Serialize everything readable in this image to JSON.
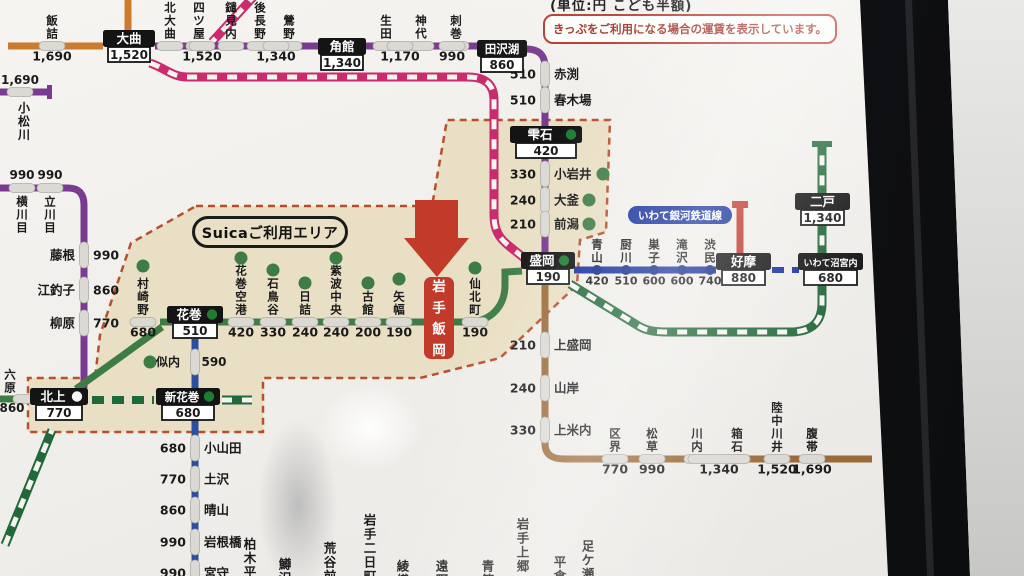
{
  "photo": {
    "caption": "(単位:円 こども半額)",
    "notice": "きっぷをご利用になる場合の運賃を表示しています。"
  },
  "labels": {
    "suica_area": "Suicaご利用エリア",
    "igr": "いわて銀河鉄道線"
  },
  "colors": {
    "orange": "#cc7a2e",
    "purple": "#7a3a92",
    "pink": "#c92b6d",
    "green": "#3e7c46",
    "shin": "#21683a",
    "kama": "#2b4fa0",
    "igr": "#16309e",
    "yamada": "#9c6a38",
    "hanawa": "#c0392b",
    "stripe": "#f6f4f0",
    "dot": "#3e7c46",
    "igrdot": "#122a8a",
    "pill": "#dbd9d4",
    "pillStroke": "#aeaca7",
    "beige": "#e9dfc4",
    "beigeBorder": "#b5502c",
    "boxBlack": "#141414",
    "arrowRed": "#c23a2a",
    "circleGreen": "#1e7d32",
    "circleWhite": "#f5f5f5",
    "text": "#1a1a1a"
  },
  "map": {
    "suica_polygon": "196,206 432,206 447,120 610,120 606,232 580,240 577,285 500,358 420,378 263,378 263,432 28,432 28,378 95,378 100,335 131,243",
    "elements": [
      {
        "t": "ln",
        "n": "line-ou-main",
        "d": "M 8,46 L 103,46",
        "c": "orange",
        "w": 7,
        "st": "solid"
      },
      {
        "t": "ln",
        "n": "line-ou-north",
        "d": "M 128,0 L 128,31",
        "c": "orange",
        "w": 7,
        "st": "solid"
      },
      {
        "t": "ln",
        "n": "line-kitakami-west",
        "d": "M 0,92 L 50,92",
        "c": "purple",
        "w": 7,
        "st": "solid"
      },
      {
        "t": "rc",
        "n": "line-kitakami-west-endcap",
        "x": 47,
        "y": 85,
        "w": 5,
        "h": 14,
        "c": "purple"
      },
      {
        "t": "ln",
        "n": "line-kitakami",
        "d": "M 0,188 L 68,188 C 79,188 84,194 84,205 L 84,388",
        "c": "purple",
        "w": 7,
        "st": "solid"
      },
      {
        "t": "ln",
        "n": "line-akita-shinkansen-nw",
        "d": "M 256,-6 L 212,42",
        "c": "pink",
        "w": 9,
        "st": "striped"
      },
      {
        "t": "ln",
        "n": "line-akita-shinkansen",
        "d": "M 150,63 C 167,69 172,77 188,77 L 468,77 C 486,77 494,85 494,100 L 494,215 C 494,230 499,238 509,246 L 524,258",
        "c": "pink",
        "w": 9,
        "st": "striped"
      },
      {
        "t": "ln",
        "n": "line-tazawako-top",
        "d": "M 155,46 L 478,46",
        "c": "purple",
        "w": 7,
        "st": "solid"
      },
      {
        "t": "ln",
        "n": "line-tazawako-bend",
        "d": "M 526,49 C 540,49 545,56 545,67 L 545,126",
        "c": "purple",
        "w": 7,
        "st": "solid"
      },
      {
        "t": "ln",
        "n": "line-tazawako-south",
        "d": "M 545,158 L 545,254",
        "c": "purple",
        "w": 7,
        "st": "solid"
      },
      {
        "t": "ln",
        "n": "line-tohoku-main-west",
        "d": "M 0,399 L 31,399",
        "c": "green",
        "w": 7,
        "st": "solid"
      },
      {
        "t": "ln",
        "n": "line-tohoku-main-diag",
        "d": "M 76,389 L 162,327",
        "c": "green",
        "w": 7,
        "st": "solid"
      },
      {
        "t": "ln",
        "n": "line-tohoku-main",
        "d": "M 160,322 L 474,322",
        "c": "green",
        "w": 7,
        "st": "solid"
      },
      {
        "t": "ln",
        "n": "line-tohoku-main-morioka",
        "d": "M 455,322 L 468,322 C 492,322 505,305 505,285 L 505,272 L 522,271",
        "c": "green",
        "w": 7,
        "st": "solid"
      },
      {
        "t": "ln",
        "n": "line-kamaishi",
        "d": "M 195,339 L 195,576",
        "c": "kama",
        "w": 7,
        "st": "solid"
      },
      {
        "t": "ln",
        "n": "line-tohoku-shinkansen-sw",
        "d": "M 5,545 L 52,430",
        "c": "shin",
        "w": 9,
        "st": "striped"
      },
      {
        "t": "ln",
        "n": "line-tohoku-shinkansen-dash",
        "d": "M 92,400 L 154,400",
        "c": "shin",
        "w": 8,
        "st": "dashed"
      },
      {
        "t": "ln",
        "n": "line-tohoku-shinkansen-stub",
        "d": "M 222,400 L 252,400",
        "c": "shin",
        "w": 9,
        "st": "striped"
      },
      {
        "t": "ln",
        "n": "line-tohoku-shinkansen-north",
        "d": "M 570,284 L 637,325 C 646,331 655,332 668,332 L 790,332 C 812,332 822,322 822,303 L 822,146",
        "c": "shin",
        "w": 9,
        "st": "striped"
      },
      {
        "t": "rc",
        "n": "line-shinkansen-endcap",
        "x": 812,
        "y": 141,
        "w": 20,
        "h": 6,
        "c": "shin"
      },
      {
        "t": "ln",
        "n": "line-igr",
        "d": "M 574,270 L 716,270",
        "c": "igr",
        "w": 7,
        "st": "solid"
      },
      {
        "t": "ln",
        "n": "line-igr-dash",
        "d": "M 772,270 L 799,270",
        "c": "igr",
        "w": 6,
        "st": "dashed"
      },
      {
        "t": "ln",
        "n": "line-hanawa",
        "d": "M 740,208 L 740,253",
        "c": "hanawa",
        "w": 7,
        "st": "solid"
      },
      {
        "t": "rc",
        "n": "line-hanawa-endcap",
        "x": 732,
        "y": 201,
        "w": 16,
        "h": 7,
        "c": "hanawa"
      },
      {
        "t": "ln",
        "n": "line-yamada",
        "d": "M 545,285 L 545,443 C 545,455 552,459 565,459 L 872,459",
        "c": "yamada",
        "w": 7,
        "st": "solid"
      },
      {
        "t": "col",
        "n": "station-iizume",
        "x": 52,
        "nm": "飯詰",
        "ly": 46,
        "fare": "1,690"
      },
      {
        "t": "col",
        "n": "station-kitaomagari",
        "x": 170,
        "nm": "北大曲",
        "ly": 46
      },
      {
        "t": "col",
        "n": "station-ugoyotsuya",
        "x": 199,
        "nm": "羽後四ツ屋",
        "ly": 46
      },
      {
        "t": "col",
        "n": "station-yariminai",
        "x": 231,
        "nm": "鑓見内",
        "ly": 46
      },
      {
        "t": "col",
        "n": "station-ugonagano",
        "x": 260,
        "nm": "羽後長野",
        "ly": 46
      },
      {
        "t": "col",
        "n": "station-uguisuno",
        "x": 289,
        "nm": "鶯野",
        "ly": 46
      },
      {
        "t": "col",
        "n": "station-shoden",
        "x": 386,
        "nm": "生田",
        "ly": 46
      },
      {
        "t": "col",
        "n": "station-jindai",
        "x": 421,
        "nm": "神代",
        "ly": 46
      },
      {
        "t": "col",
        "n": "station-sashimaki",
        "x": 456,
        "nm": "刺巻",
        "ly": 46
      },
      {
        "t": "fp",
        "n": "fare-1520",
        "x": 202,
        "y": 46,
        "tx": "1,520"
      },
      {
        "t": "fp",
        "n": "fare-1340",
        "x": 276,
        "y": 46,
        "tx": "1,340"
      },
      {
        "t": "fp",
        "n": "fare-1170",
        "x": 400,
        "y": 46,
        "tx": "1,170"
      },
      {
        "t": "fp",
        "n": "fare-990",
        "x": 452,
        "y": 46,
        "tx": "990"
      },
      {
        "t": "fa",
        "n": "station-yokokawame",
        "x": 22,
        "ly": 188,
        "fare": "990",
        "nm": "横川目"
      },
      {
        "t": "fa",
        "n": "station-tatekawame",
        "x": 50,
        "ly": 188,
        "fare": "990",
        "nm": "立川目"
      },
      {
        "t": "rw",
        "n": "station-fujine",
        "lx": 84,
        "y": 255,
        "fare": "990",
        "nm": "藤根",
        "side": "l"
      },
      {
        "t": "rw",
        "n": "station-ezuriko",
        "lx": 84,
        "y": 290,
        "fare": "860",
        "nm": "江釣子",
        "side": "l"
      },
      {
        "t": "rw",
        "n": "station-yanagihara",
        "lx": 84,
        "y": 323,
        "fare": "770",
        "nm": "柳原",
        "side": "l"
      },
      {
        "t": "pl",
        "n": "station-komatsukawa-tick",
        "x": 20,
        "y": 92,
        "o": "h"
      },
      {
        "t": "ht",
        "n": "fare-komatsukawa",
        "x": 20,
        "y": 84,
        "tx": "1,690",
        "s": 12,
        "a": "middle"
      },
      {
        "t": "vn",
        "n": "station-komatsukawa",
        "x": 24,
        "y": 100,
        "tx": "小松川",
        "s": 12
      },
      {
        "t": "rw",
        "n": "station-akabuchi",
        "lx": 545,
        "y": 74,
        "fare": "510",
        "nm": "赤渕"
      },
      {
        "t": "rw",
        "n": "station-harukiba",
        "lx": 545,
        "y": 100,
        "fare": "510",
        "nm": "春木場"
      },
      {
        "t": "rw",
        "n": "station-koiwai",
        "lx": 545,
        "y": 174,
        "fare": "330",
        "nm": "小岩井",
        "dx": 603
      },
      {
        "t": "rw",
        "n": "station-okama",
        "lx": 545,
        "y": 200,
        "fare": "240",
        "nm": "大釜",
        "dx": 589
      },
      {
        "t": "rw",
        "n": "station-maekata",
        "lx": 545,
        "y": 224,
        "fare": "210",
        "nm": "前潟",
        "dx": 589
      },
      {
        "t": "vn",
        "n": "station-rokuhara",
        "x": 10,
        "ye": 393,
        "tx": "六原",
        "s": 11.5
      },
      {
        "t": "pl",
        "n": "station-rokuhara-tick",
        "x": 26,
        "y": 399,
        "o": "h"
      },
      {
        "t": "ht",
        "n": "fare-rokuhara",
        "x": 12,
        "y": 412,
        "tx": "860",
        "s": 12,
        "a": "middle"
      },
      {
        "t": "col",
        "n": "station-murasakino",
        "x": 143,
        "nm": "村崎野",
        "ly": 322,
        "dy": 266,
        "fare": "680"
      },
      {
        "t": "col",
        "n": "station-hanamakikuko",
        "x": 241,
        "nm": "花巻空港",
        "ly": 322,
        "dy": 258,
        "fare": "420"
      },
      {
        "t": "col",
        "n": "station-ishidoriya",
        "x": 273,
        "nm": "石鳥谷",
        "ly": 322,
        "dy": 270,
        "fare": "330"
      },
      {
        "t": "col",
        "n": "station-hizume",
        "x": 305,
        "nm": "日詰",
        "ly": 322,
        "dy": 283,
        "fare": "240"
      },
      {
        "t": "col",
        "n": "station-shiwachuo",
        "x": 336,
        "nm": "紫波中央",
        "ly": 322,
        "dy": 258,
        "fare": "240"
      },
      {
        "t": "col",
        "n": "station-furudate",
        "x": 368,
        "nm": "古館",
        "ly": 322,
        "dy": 283,
        "fare": "200"
      },
      {
        "t": "col",
        "n": "station-yahaba",
        "x": 399,
        "nm": "矢幅",
        "ly": 322,
        "dy": 279,
        "fare": "190"
      },
      {
        "t": "col",
        "n": "station-senbokucho",
        "x": 475,
        "nm": "仙北町",
        "ly": 322,
        "dy": 268,
        "fare": "190"
      },
      {
        "t": "dt",
        "n": "station-nitanai-dot",
        "x": 150,
        "y": 362
      },
      {
        "t": "ht",
        "n": "station-nitanai",
        "x": 168,
        "y": 366,
        "tx": "似内",
        "s": 12,
        "a": "middle"
      },
      {
        "t": "pl",
        "n": "station-nitanai-tick",
        "x": 195,
        "y": 362,
        "o": "v"
      },
      {
        "t": "ht",
        "n": "fare-nitanai",
        "x": 214,
        "y": 366,
        "tx": "590",
        "s": 12,
        "a": "middle"
      },
      {
        "t": "rw",
        "n": "station-oyamada",
        "lx": 195,
        "y": 448,
        "fare": "680",
        "nm": "小山田"
      },
      {
        "t": "rw",
        "n": "station-tsuchizawa",
        "lx": 195,
        "y": 479,
        "fare": "770",
        "nm": "土沢"
      },
      {
        "t": "rw",
        "n": "station-hareyama",
        "lx": 195,
        "y": 510,
        "fare": "860",
        "nm": "晴山"
      },
      {
        "t": "rw",
        "n": "station-iwanebashi",
        "lx": 195,
        "y": 542,
        "fare": "990",
        "nm": "岩根橋"
      },
      {
        "t": "rw",
        "n": "station-miyamori",
        "lx": 195,
        "y": 573,
        "fare": "990",
        "nm": "宮守"
      },
      {
        "t": "vn",
        "n": "station-kashiwagidaira",
        "x": 250,
        "y": 536,
        "tx": "柏木平",
        "s": 12.5
      },
      {
        "t": "vn",
        "n": "station-masuzawa",
        "x": 285,
        "y": 556,
        "tx": "鱒沢",
        "s": 12.5
      },
      {
        "t": "vn",
        "n": "station-aratamae",
        "x": 330,
        "y": 540,
        "tx": "荒谷前",
        "s": 12.5
      },
      {
        "t": "vn",
        "n": "station-iwatefutsukamachi",
        "x": 370,
        "y": 512,
        "tx": "岩手二日町",
        "s": 12.5
      },
      {
        "t": "vn",
        "n": "station-ayaori",
        "x": 403,
        "y": 558,
        "tx": "綾織",
        "s": 12.5
      },
      {
        "t": "vn",
        "n": "station-tono",
        "x": 442,
        "y": 558,
        "tx": "遠野",
        "s": 12.5
      },
      {
        "t": "vn",
        "n": "station-aozasa",
        "x": 488,
        "y": 558,
        "tx": "青笹",
        "s": 12.5
      },
      {
        "t": "vn",
        "n": "station-iwatekamigo",
        "x": 523,
        "y": 516,
        "tx": "岩手上郷",
        "s": 12.5
      },
      {
        "t": "vn",
        "n": "station-hirakura",
        "x": 560,
        "y": 554,
        "tx": "平倉",
        "s": 12.5
      },
      {
        "t": "vn",
        "n": "station-ashigase",
        "x": 588,
        "y": 538,
        "tx": "足ケ瀬",
        "s": 12.5
      },
      {
        "t": "col",
        "n": "station-aoyama",
        "x": 597,
        "nm": "青山",
        "ly": 270,
        "ye": 263,
        "dol": true,
        "fare": "420",
        "fs": 11
      },
      {
        "t": "col",
        "n": "station-kuriyagawa",
        "x": 626,
        "nm": "厨川",
        "ly": 270,
        "ye": 263,
        "dol": true,
        "fare": "510",
        "fs": 11
      },
      {
        "t": "col",
        "n": "station-sugo",
        "x": 654,
        "nm": "巣子",
        "ly": 270,
        "ye": 263,
        "dol": true,
        "fare": "600",
        "fs": 11
      },
      {
        "t": "col",
        "n": "station-takizawa",
        "x": 682,
        "nm": "滝沢",
        "ly": 270,
        "ye": 263,
        "dol": true,
        "fare": "600",
        "fs": 11
      },
      {
        "t": "col",
        "n": "station-shibutami",
        "x": 710,
        "nm": "渋民",
        "ly": 270,
        "ye": 263,
        "dol": true,
        "fare": "740",
        "fs": 11
      },
      {
        "t": "rw",
        "n": "station-kamimorioka",
        "lx": 545,
        "y": 345,
        "fare": "210",
        "nm": "上盛岡"
      },
      {
        "t": "rw",
        "n": "station-yamagishi",
        "lx": 545,
        "y": 388,
        "fare": "240",
        "nm": "山岸"
      },
      {
        "t": "rw",
        "n": "station-kamiyonai",
        "lx": 545,
        "y": 430,
        "fare": "330",
        "nm": "上米内"
      },
      {
        "t": "col",
        "n": "station-kuzakai",
        "x": 615,
        "nm": "区界",
        "ly": 459,
        "fare": "770"
      },
      {
        "t": "col",
        "n": "station-matsukusa",
        "x": 652,
        "nm": "松草",
        "ly": 459,
        "fare": "990"
      },
      {
        "t": "col",
        "n": "station-kawauchi",
        "x": 697,
        "nm": "川内",
        "ly": 459
      },
      {
        "t": "col",
        "n": "station-hakoishi",
        "x": 737,
        "nm": "箱石",
        "ly": 459
      },
      {
        "t": "fp",
        "n": "fare-kawauchi-hakoishi",
        "x": 719,
        "y": 459,
        "tx": "1,340",
        "len": 62
      },
      {
        "t": "col",
        "n": "station-rikuchukawai",
        "x": 777,
        "nm": "陸中川井",
        "ly": 459,
        "fare": "1,520"
      },
      {
        "t": "col",
        "n": "station-haratai",
        "x": 812,
        "nm": "腹帯",
        "ly": 459,
        "fare": "1,690"
      },
      {
        "t": "ar",
        "n": "current-station-arrow"
      },
      {
        "t": "rb",
        "n": "current-station-iwateiioka",
        "x": 424,
        "y": 277,
        "w": 30,
        "h": 82,
        "tx": "岩手飯岡"
      },
      {
        "t": "bx",
        "n": "station-box-omagari",
        "x": 103,
        "y": 30,
        "w": 52,
        "nm": "大曲",
        "fare": "1,520"
      },
      {
        "t": "bx",
        "n": "station-box-kakunodate",
        "x": 318,
        "y": 38,
        "w": 48,
        "nm": "角館",
        "fare": "1,340"
      },
      {
        "t": "bx",
        "n": "station-box-tazawako",
        "x": 477,
        "y": 40,
        "w": 50,
        "nm": "田沢湖",
        "fare": "860",
        "ns": 11.5
      },
      {
        "t": "bx",
        "n": "station-box-shizukuishi",
        "x": 510,
        "y": 126,
        "w": 72,
        "nm": "雫石",
        "fare": "420",
        "circle": "circleGreen"
      },
      {
        "t": "bx",
        "n": "station-box-hanamaki",
        "x": 167,
        "y": 306,
        "w": 56,
        "nm": "花巻",
        "fare": "510",
        "circle": "circleGreen"
      },
      {
        "t": "bx",
        "n": "station-box-morioka",
        "x": 521,
        "y": 252,
        "w": 54,
        "nm": "盛岡",
        "fare": "190",
        "circle": "circleGreen"
      },
      {
        "t": "bx",
        "n": "station-box-kitakami",
        "x": 30,
        "y": 388,
        "w": 58,
        "nm": "北上",
        "fare": "770",
        "circle": "circleWhite"
      },
      {
        "t": "bx",
        "n": "station-box-shinhanamaki",
        "x": 156,
        "y": 388,
        "w": 64,
        "nm": "新花巻",
        "fare": "680",
        "ns": 11.5,
        "circle": "circleGreen"
      },
      {
        "t": "bx",
        "n": "station-box-koma",
        "x": 716,
        "y": 253,
        "w": 55,
        "nm": "好摩",
        "fare": "880"
      },
      {
        "t": "bx",
        "n": "station-box-iwatenumakunai",
        "x": 798,
        "y": 253,
        "w": 65,
        "nm": "いわて沼宮内",
        "fare": "680",
        "ns": 9
      },
      {
        "t": "bx",
        "n": "station-box-ninohe",
        "x": 795,
        "y": 193,
        "w": 55,
        "nm": "二戸",
        "fare": "1,340"
      }
    ]
  }
}
